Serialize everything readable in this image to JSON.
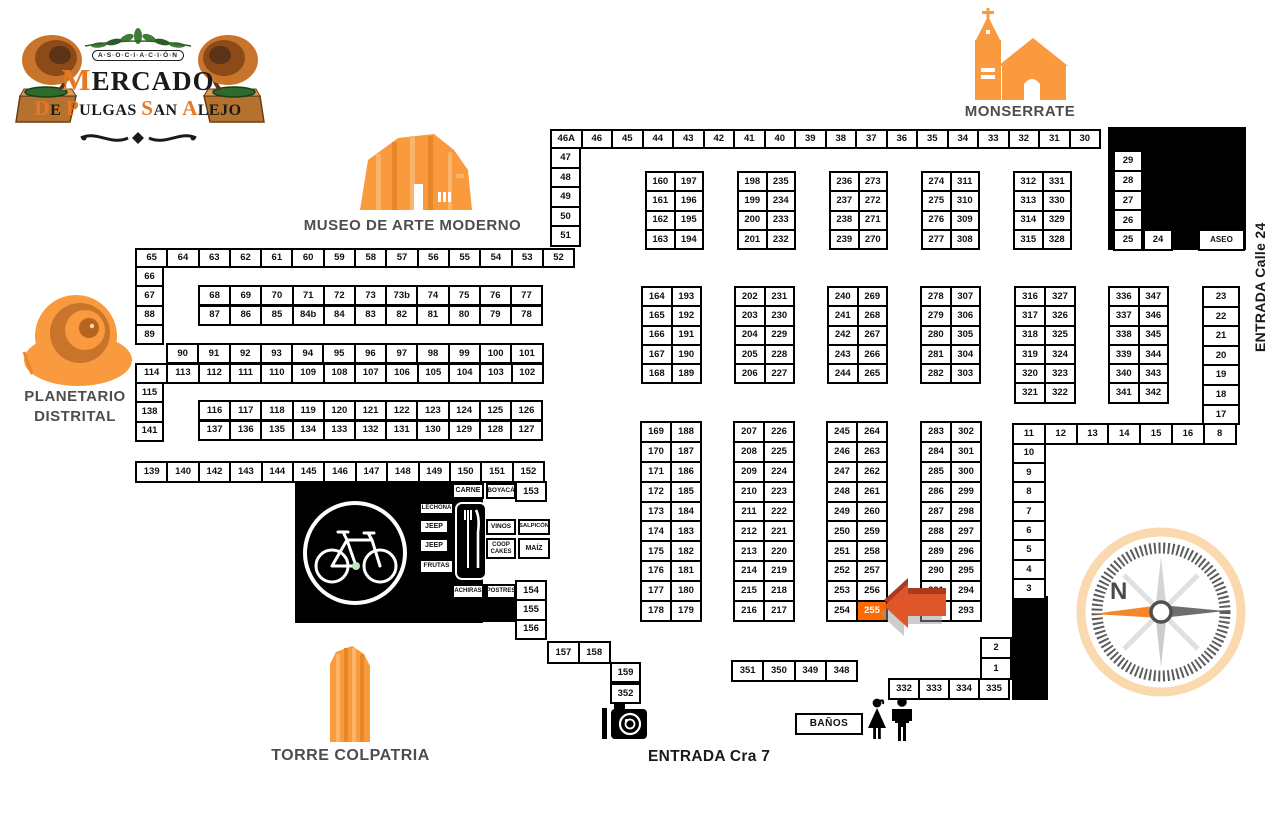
{
  "logo": {
    "asociacion": "A·S·O·C·I·A·C·I·Ó·N",
    "title": "MERCADO",
    "subtitle": "De Pulgas San Alejo"
  },
  "landmarks": {
    "monserrate": "MONSERRATE",
    "museo": "MUSEO DE ARTE MODERNO",
    "planetario_line1": "PLANETARIO",
    "planetario_line2": "DISTRITAL",
    "torre": "TORRE COLPATRIA"
  },
  "entrances": {
    "calle24": "ENTRADA Calle 24",
    "cra7": "ENTRADA Cra 7"
  },
  "compass": {
    "north_label": "N"
  },
  "banos_label": "BAÑOS",
  "highlighted_stall": "255",
  "colors": {
    "accent_orange": "#f89a3d",
    "highlight": "#ff6a00",
    "arrow": "#e0562b"
  },
  "map": {
    "blocks": [
      {
        "name": "row-46a-30",
        "x": 550,
        "y": 129,
        "cols": 18,
        "cw": 28.5,
        "ch": 16,
        "labels": [
          "46A",
          "46",
          "45",
          "44",
          "43",
          "42",
          "41",
          "40",
          "39",
          "38",
          "37",
          "36",
          "35",
          "34",
          "33",
          "32",
          "31",
          "30"
        ]
      },
      {
        "name": "col-47-51",
        "x": 550,
        "y": 147,
        "cols": 1,
        "cw": 27,
        "ch": 17.6,
        "labels": [
          "47",
          "48",
          "49",
          "50",
          "51"
        ]
      },
      {
        "name": "block-160-194",
        "x": 645,
        "y": 171,
        "cols": 2,
        "cw": 26.5,
        "ch": 17.3,
        "labels": [
          "160",
          "197",
          "161",
          "196",
          "162",
          "195",
          "163",
          "194"
        ]
      },
      {
        "name": "block-198-232",
        "x": 737,
        "y": 171,
        "cols": 2,
        "cw": 26.5,
        "ch": 17.3,
        "labels": [
          "198",
          "235",
          "199",
          "234",
          "200",
          "233",
          "201",
          "232"
        ]
      },
      {
        "name": "block-236-270",
        "x": 829,
        "y": 171,
        "cols": 2,
        "cw": 26.5,
        "ch": 17.3,
        "labels": [
          "236",
          "273",
          "237",
          "272",
          "238",
          "271",
          "239",
          "270"
        ]
      },
      {
        "name": "block-274-308",
        "x": 921,
        "y": 171,
        "cols": 2,
        "cw": 26.5,
        "ch": 17.3,
        "labels": [
          "274",
          "311",
          "275",
          "310",
          "276",
          "309",
          "277",
          "308"
        ]
      },
      {
        "name": "block-312-328",
        "x": 1013,
        "y": 171,
        "cols": 2,
        "cw": 26.5,
        "ch": 17.3,
        "labels": [
          "312",
          "331",
          "313",
          "330",
          "314",
          "329",
          "315",
          "328"
        ]
      },
      {
        "name": "col-29-25",
        "x": 1113,
        "y": 150,
        "cols": 1,
        "cw": 26,
        "ch": 17.8,
        "labels": [
          "29",
          "28",
          "27",
          "26",
          "25"
        ]
      },
      {
        "name": "cell-24",
        "x": 1143,
        "y": 229,
        "cols": 1,
        "cw": 26,
        "ch": 17.8,
        "labels": [
          "24"
        ]
      },
      {
        "name": "cell-aseo",
        "x": 1198,
        "y": 229,
        "cols": 1,
        "cw": 43,
        "ch": 17.8,
        "fs": 8,
        "labels": [
          "ASEO"
        ]
      },
      {
        "name": "row-65-52",
        "x": 135,
        "y": 248,
        "cols": 14,
        "cw": 29.3,
        "ch": 16,
        "labels": [
          "65",
          "64",
          "63",
          "62",
          "61",
          "60",
          "59",
          "58",
          "57",
          "56",
          "55",
          "54",
          "53",
          "52"
        ]
      },
      {
        "name": "col-66-89",
        "x": 135,
        "y": 266,
        "cols": 1,
        "cw": 25,
        "ch": 17.3,
        "labels": [
          "66",
          "67",
          "88",
          "89"
        ]
      },
      {
        "name": "row-68-77",
        "x": 198,
        "y": 285,
        "cols": 11,
        "cw": 29.2,
        "ch": 17.3,
        "labels": [
          "68",
          "69",
          "70",
          "71",
          "72",
          "73",
          "73b",
          "74",
          "75",
          "76",
          "77"
        ]
      },
      {
        "name": "row-87-78",
        "x": 198,
        "y": 304.5,
        "cols": 11,
        "cw": 29.2,
        "ch": 17.3,
        "labels": [
          "87",
          "86",
          "85",
          "84b",
          "84",
          "83",
          "82",
          "81",
          "80",
          "79",
          "78"
        ]
      },
      {
        "name": "row-90-101",
        "x": 166,
        "y": 343,
        "cols": 12,
        "cw": 29.3,
        "ch": 17.3,
        "labels": [
          "90",
          "91",
          "92",
          "93",
          "94",
          "95",
          "96",
          "97",
          "98",
          "99",
          "100",
          "101"
        ]
      },
      {
        "name": "row-114-102",
        "x": 135,
        "y": 362.5,
        "cols": 13,
        "cw": 29.3,
        "ch": 17.3,
        "labels": [
          "114",
          "113",
          "112",
          "111",
          "110",
          "109",
          "108",
          "107",
          "106",
          "105",
          "104",
          "103",
          "102"
        ]
      },
      {
        "name": "col-115-141",
        "x": 135,
        "y": 382,
        "cols": 1,
        "cw": 25,
        "ch": 17.3,
        "labels": [
          "115",
          "138",
          "141"
        ]
      },
      {
        "name": "row-116-126",
        "x": 198,
        "y": 400,
        "cols": 11,
        "cw": 29.2,
        "ch": 17.3,
        "labels": [
          "116",
          "117",
          "118",
          "119",
          "120",
          "121",
          "122",
          "123",
          "124",
          "125",
          "126"
        ]
      },
      {
        "name": "row-137-127",
        "x": 198,
        "y": 419.5,
        "cols": 11,
        "cw": 29.2,
        "ch": 17.3,
        "labels": [
          "137",
          "136",
          "135",
          "134",
          "133",
          "132",
          "131",
          "130",
          "129",
          "128",
          "127"
        ]
      },
      {
        "name": "row-139-152",
        "x": 135,
        "y": 461,
        "cols": 13,
        "cw": 29.4,
        "ch": 18,
        "labels": [
          "139",
          "140",
          "142",
          "143",
          "144",
          "145",
          "146",
          "147",
          "148",
          "149",
          "150",
          "151",
          "152"
        ]
      },
      {
        "name": "cell-153",
        "x": 515,
        "y": 481,
        "cols": 1,
        "cw": 28,
        "ch": 17,
        "labels": [
          "153"
        ]
      },
      {
        "name": "col-154-156",
        "x": 515,
        "y": 580,
        "cols": 1,
        "cw": 28,
        "ch": 17.3,
        "labels": [
          "154",
          "155",
          "156"
        ]
      },
      {
        "name": "row-157-158",
        "x": 547,
        "y": 641,
        "cols": 2,
        "cw": 28.8,
        "ch": 18.5,
        "labels": [
          "157",
          "158"
        ]
      },
      {
        "name": "cell-159",
        "x": 610,
        "y": 661.5,
        "cols": 1,
        "cw": 27,
        "ch": 17.5,
        "labels": [
          "159"
        ]
      },
      {
        "name": "cell-352",
        "x": 610,
        "y": 683,
        "cols": 1,
        "cw": 27,
        "ch": 17,
        "labels": [
          "352"
        ]
      },
      {
        "name": "block-164-189",
        "x": 641,
        "y": 286,
        "cols": 2,
        "cw": 27.5,
        "ch": 17.3,
        "labels": [
          "164",
          "193",
          "165",
          "192",
          "166",
          "191",
          "167",
          "190",
          "168",
          "189"
        ]
      },
      {
        "name": "block-202-227",
        "x": 734,
        "y": 286,
        "cols": 2,
        "cw": 27.5,
        "ch": 17.3,
        "labels": [
          "202",
          "231",
          "203",
          "230",
          "204",
          "229",
          "205",
          "228",
          "206",
          "227"
        ]
      },
      {
        "name": "block-240-265",
        "x": 827,
        "y": 286,
        "cols": 2,
        "cw": 27.5,
        "ch": 17.3,
        "labels": [
          "240",
          "269",
          "241",
          "268",
          "242",
          "267",
          "243",
          "266",
          "244",
          "265"
        ]
      },
      {
        "name": "block-278-303",
        "x": 920,
        "y": 286,
        "cols": 2,
        "cw": 27.5,
        "ch": 17.3,
        "labels": [
          "278",
          "307",
          "279",
          "306",
          "280",
          "305",
          "281",
          "304",
          "282",
          "303"
        ]
      },
      {
        "name": "block-316-322",
        "x": 1014,
        "y": 286,
        "cols": 2,
        "cw": 28,
        "ch": 17.3,
        "labels": [
          "316",
          "327",
          "317",
          "326",
          "318",
          "325",
          "319",
          "324",
          "320",
          "323",
          "321",
          "322"
        ]
      },
      {
        "name": "block-336-342",
        "x": 1108,
        "y": 286,
        "cols": 2,
        "cw": 27.5,
        "ch": 17.3,
        "labels": [
          "336",
          "347",
          "337",
          "346",
          "338",
          "345",
          "339",
          "344",
          "340",
          "343",
          "341",
          "342"
        ]
      },
      {
        "name": "col-23-17",
        "x": 1202,
        "y": 286,
        "cols": 1,
        "cw": 34,
        "ch": 17.6,
        "labels": [
          "23",
          "22",
          "21",
          "20",
          "19",
          "18",
          "17"
        ]
      },
      {
        "name": "row-11-8",
        "x": 1012,
        "y": 423,
        "cols": 7,
        "cw": 29.8,
        "ch": 17.5,
        "labels": [
          "11",
          "12",
          "13",
          "14",
          "15",
          "16",
          "8"
        ]
      },
      {
        "name": "col-10-3",
        "x": 1012,
        "y": 442.5,
        "cols": 1,
        "cw": 29.8,
        "ch": 17.4,
        "labels": [
          "10",
          "9",
          "8",
          "7",
          "6",
          "5",
          "4",
          "3"
        ]
      },
      {
        "name": "block-169-179",
        "x": 640,
        "y": 421,
        "cols": 2,
        "cw": 28,
        "ch": 17.9,
        "labels": [
          "169",
          "188",
          "170",
          "187",
          "171",
          "186",
          "172",
          "185",
          "173",
          "184",
          "174",
          "183",
          "175",
          "182",
          "176",
          "181",
          "177",
          "180",
          "178",
          "179"
        ]
      },
      {
        "name": "block-207-217",
        "x": 733,
        "y": 421,
        "cols": 2,
        "cw": 28,
        "ch": 17.9,
        "labels": [
          "207",
          "226",
          "208",
          "225",
          "209",
          "224",
          "210",
          "223",
          "211",
          "222",
          "212",
          "221",
          "213",
          "220",
          "214",
          "219",
          "215",
          "218",
          "216",
          "217"
        ]
      },
      {
        "name": "block-245-255",
        "x": 826,
        "y": 421,
        "cols": 2,
        "cw": 28,
        "ch": 17.9,
        "hl": [
          "255"
        ],
        "labels": [
          "245",
          "264",
          "246",
          "263",
          "247",
          "262",
          "248",
          "261",
          "249",
          "260",
          "250",
          "259",
          "251",
          "258",
          "252",
          "257",
          "253",
          "256",
          "254",
          "255"
        ]
      },
      {
        "name": "block-283-293",
        "x": 920,
        "y": 421,
        "cols": 2,
        "cw": 28,
        "ch": 17.9,
        "labels": [
          "283",
          "302",
          "284",
          "301",
          "285",
          "300",
          "286",
          "299",
          "287",
          "298",
          "288",
          "297",
          "289",
          "296",
          "290",
          "295",
          "291",
          "294",
          "",
          "293"
        ]
      },
      {
        "name": "col-2-1",
        "x": 980,
        "y": 637,
        "cols": 1,
        "cw": 28,
        "ch": 18.3,
        "labels": [
          "2",
          "1"
        ]
      },
      {
        "name": "row-332-335",
        "x": 888,
        "y": 677.5,
        "cols": 4,
        "cw": 28,
        "ch": 18.5,
        "labels": [
          "332",
          "333",
          "334",
          "335"
        ]
      },
      {
        "name": "row-351-348",
        "x": 731,
        "y": 660,
        "cols": 4,
        "cw": 29.3,
        "ch": 18,
        "labels": [
          "351",
          "350",
          "349",
          "348"
        ]
      }
    ],
    "food_boxes": [
      {
        "label": "CARNE",
        "x": 452,
        "y": 483,
        "w": 32,
        "h": 16,
        "fs": 7
      },
      {
        "label": "BOYACÁ",
        "x": 486,
        "y": 483,
        "w": 30,
        "h": 16,
        "fs": 6.5
      },
      {
        "label": "LECHONA",
        "x": 419,
        "y": 502,
        "w": 35,
        "h": 13,
        "fs": 6
      },
      {
        "label": "JEEP",
        "x": 419,
        "y": 519,
        "w": 30,
        "h": 15,
        "fs": 7
      },
      {
        "label": "JEEP",
        "x": 419,
        "y": 538,
        "w": 30,
        "h": 15,
        "fs": 7
      },
      {
        "label": "FRUTAS",
        "x": 419,
        "y": 559,
        "w": 35,
        "h": 15,
        "fs": 6.5
      },
      {
        "label": "VINOS",
        "x": 486,
        "y": 519,
        "w": 30,
        "h": 16,
        "fs": 6.5
      },
      {
        "label": "SALPICÓN",
        "x": 518,
        "y": 519,
        "w": 32,
        "h": 16,
        "fs": 5.8
      },
      {
        "label": "COOP CAKES",
        "x": 486,
        "y": 538,
        "w": 30,
        "h": 21,
        "fs": 6
      },
      {
        "label": "MAÍZ",
        "x": 518,
        "y": 538,
        "w": 32,
        "h": 21,
        "fs": 7
      },
      {
        "label": "ACHIRAS",
        "x": 452,
        "y": 584,
        "w": 32,
        "h": 15,
        "fs": 6
      },
      {
        "label": "POSTRES",
        "x": 486,
        "y": 584,
        "w": 30,
        "h": 15,
        "fs": 6
      }
    ]
  }
}
